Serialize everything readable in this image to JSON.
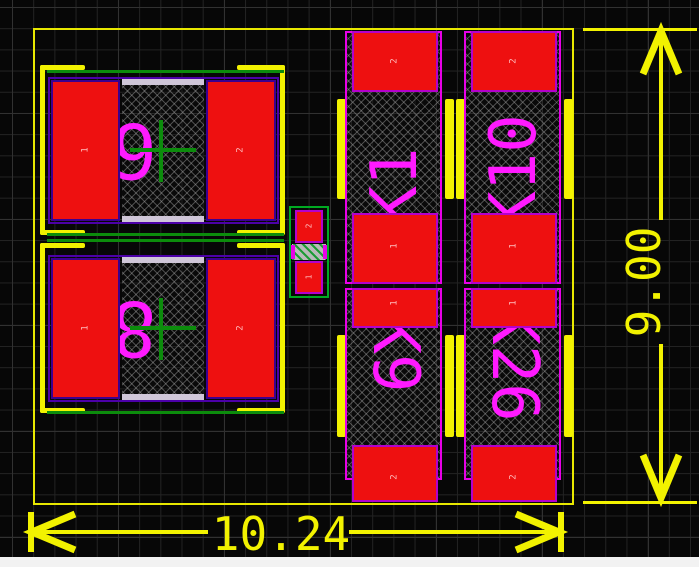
{
  "viewport": {
    "kind": "pcb-layout-canvas",
    "colors": {
      "background": "#070707",
      "grid": "#232323",
      "pad_red": "#ee1010",
      "silkscreen_yellow": "#f2f200",
      "designator_magenta": "#ff1aff",
      "courtyard_green": "#0c8c0c",
      "body_outline_purple": "#4c00a8",
      "dimension_yellow": "#f2f200"
    }
  },
  "dimensions": {
    "horizontal": {
      "value": "10.24"
    },
    "vertical": {
      "value": "9.00"
    }
  },
  "components": {
    "left_top": {
      "designator": "6",
      "pad_left": "1",
      "pad_right": "2"
    },
    "left_bottom": {
      "designator": "8",
      "pad_left": "1",
      "pad_right": "2"
    },
    "center_small": {
      "pad_top": "2",
      "pad_bottom": "1"
    },
    "col1_top": {
      "designator": "K1",
      "pad_top": "2",
      "pad_bottom": "1"
    },
    "col2_top": {
      "designator": "K10",
      "pad_top": "2",
      "pad_bottom": "1"
    },
    "col1_bottom": {
      "designator": "K9",
      "pad_top": "1",
      "pad_bottom": "2"
    },
    "col2_bottom": {
      "designator": "K26",
      "pad_top": "1",
      "pad_bottom": "2"
    }
  }
}
